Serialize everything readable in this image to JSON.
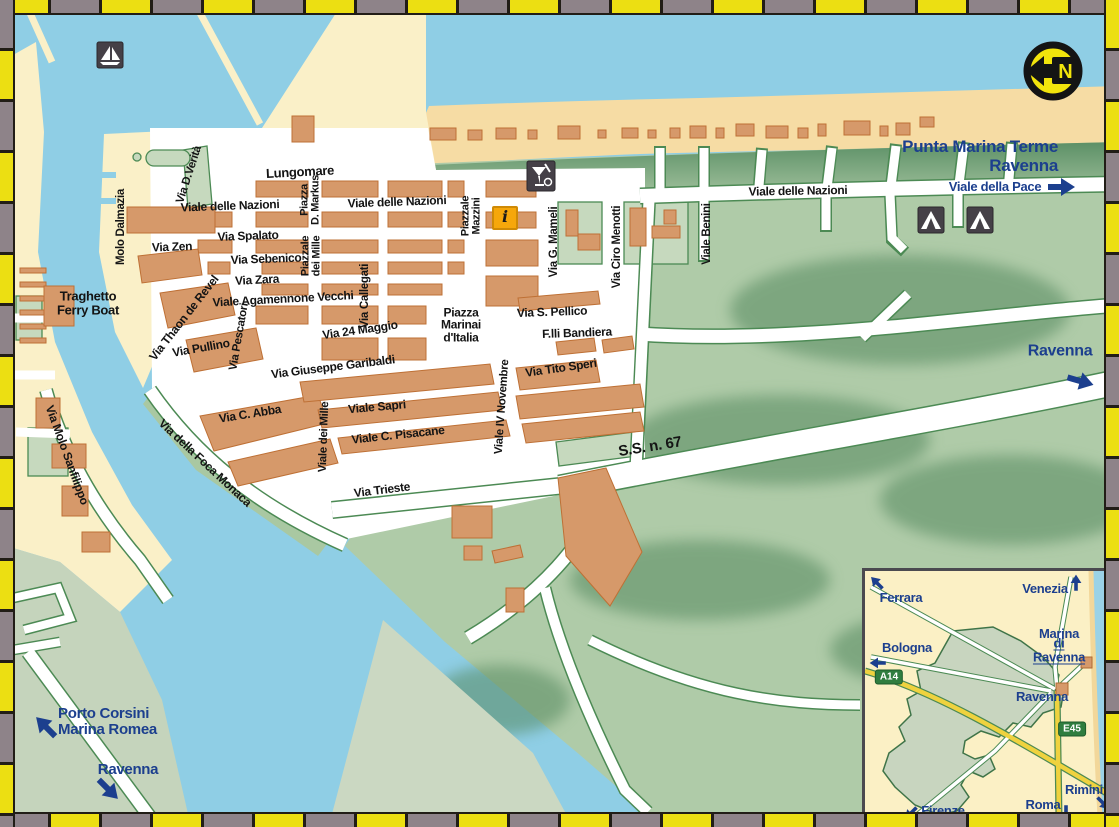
{
  "map_title": "Marina di Ravenna street map",
  "colors": {
    "water": "#8FCEE5",
    "sand": "#F6DCA4",
    "land_cream": "#FAF0C8",
    "forest_green": "#AFCBA8",
    "forest_dark": "#5C9066",
    "flats_green": "#CBD8C2",
    "building_orange": "#D6996A",
    "road_white": "#FFFFFF",
    "road_casing": "#4C8A54",
    "label_blue": "#1C3F8E",
    "border_yellow": "#ECDF12",
    "border_gray": "#8E8389",
    "highway_yellow": "#EFD23F",
    "badge_green": "#2F7D3F",
    "info_orange": "#F6A70B"
  },
  "icons": {
    "marina": "sailboat-icon",
    "info_glyph": "i",
    "north_letter": "N",
    "camping": "tent-icon",
    "refreshment": "bar-restaurant-icon"
  },
  "streets": [
    {
      "name": "Molo Dalmazia"
    },
    {
      "name": "Via D.Verità"
    },
    {
      "name": "Lungomare"
    },
    {
      "name": "Viale delle Nazioni"
    },
    {
      "name": "Piazza\nD. Markus"
    },
    {
      "name": "Viale delle Nazioni"
    },
    {
      "name": "Via Spalato"
    },
    {
      "name": "Via Zen"
    },
    {
      "name": "Via Sebenico"
    },
    {
      "name": "Via Zara"
    },
    {
      "name": "Piazzale\ndei Mille"
    },
    {
      "name": "Via Callegati"
    },
    {
      "name": "Piazzale\nMazzini"
    },
    {
      "name": "Via G. Mameli"
    },
    {
      "name": "Via Ciro Menotti"
    },
    {
      "name": "Viale Benini"
    },
    {
      "name": "Viale delle Nazioni"
    },
    {
      "name": "Viale Agamennone Vecchi"
    },
    {
      "name": "Via Thaon de Revel"
    },
    {
      "name": "Via Pullino"
    },
    {
      "name": "Via Pescatori"
    },
    {
      "name": "Via 24 Maggio"
    },
    {
      "name": "Piazza\nMarinai\nd'Italia"
    },
    {
      "name": "Via S. Pellico"
    },
    {
      "name": "F.lli Bandiera"
    },
    {
      "name": "Via Giuseppe Garibaldi"
    },
    {
      "name": "Via Tito Speri"
    },
    {
      "name": "Viale IV Novembre"
    },
    {
      "name": "Via C. Abba"
    },
    {
      "name": "Viale Sapri"
    },
    {
      "name": "Viale dei Mille"
    },
    {
      "name": "Viale C. Pisacane"
    },
    {
      "name": "Via della Foca Monaca"
    },
    {
      "name": "Via Trieste"
    },
    {
      "name": "S.S. n. 67"
    },
    {
      "name": "Via Molo Sanfilippo"
    }
  ],
  "places": {
    "ferry": "Traghetto\nFerry Boat",
    "punta_marina": "Punta Marina Terme\nRavenna",
    "viale_pace": "Viale della Pace",
    "ravenna_east": "Ravenna",
    "porto_corsini": "Porto Corsini\nMarina Romea",
    "ravenna_south": "Ravenna"
  },
  "inset": {
    "ferrara": "Ferrara",
    "venezia": "Venezia",
    "bologna": "Bologna",
    "firenze": "Firenze",
    "roma": "Roma",
    "rimini": "Rimini",
    "ravenna": "Ravenna",
    "marina_line1": "Marina",
    "marina_line2": "di Ravenna",
    "a14": "A14",
    "e45": "E45"
  }
}
